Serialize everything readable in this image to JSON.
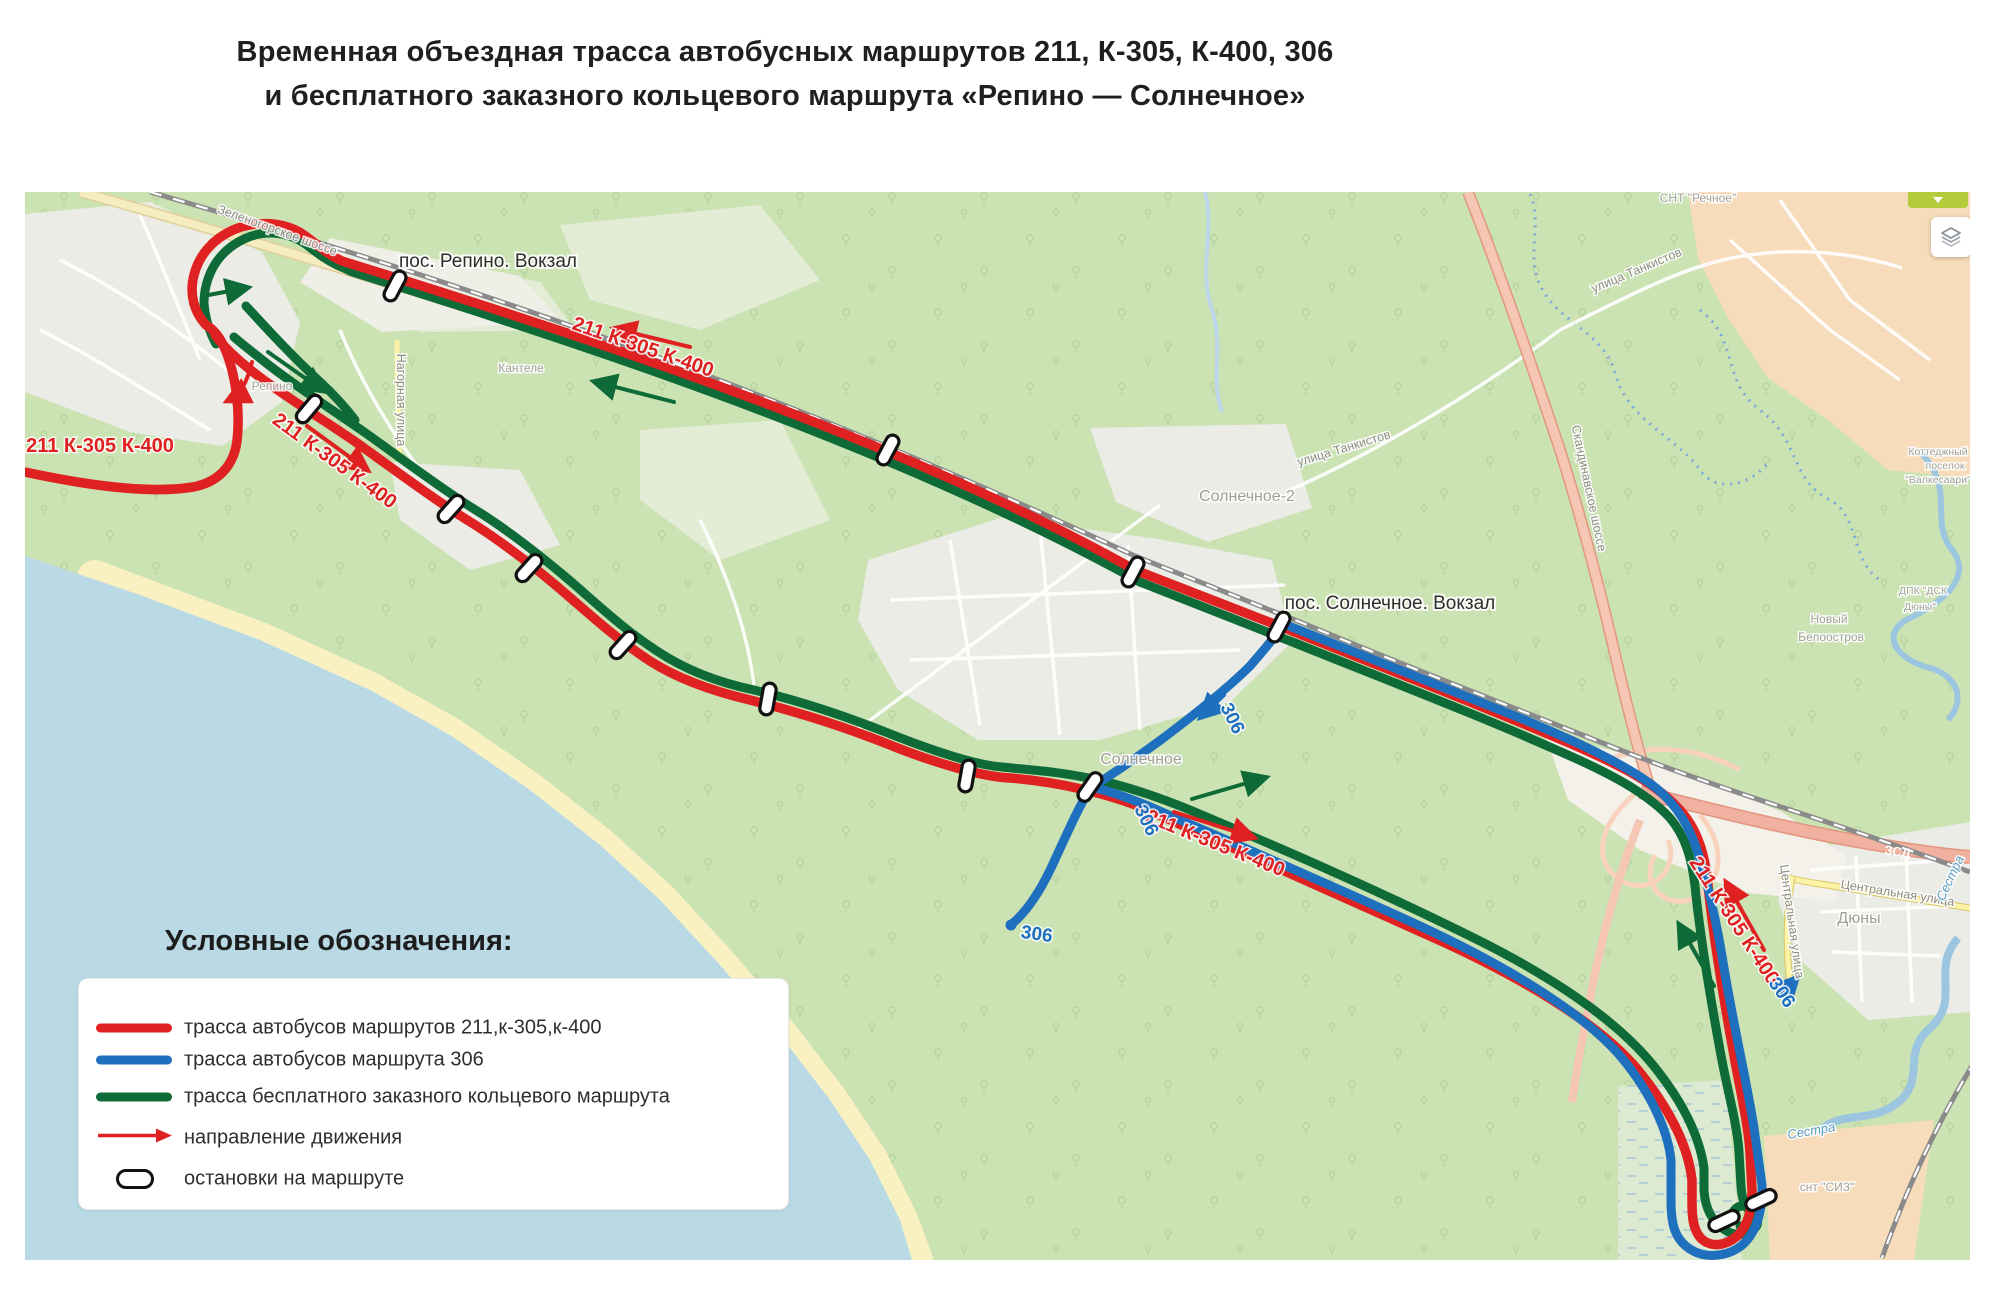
{
  "title": {
    "line1": "Временная объездная трасса автобусных маршрутов 211, К-305, К-400, 306",
    "line2": "и бесплатного заказного кольцевого маршрута «Репино — Солнечное»"
  },
  "legend": {
    "heading": "Условные обозначения:",
    "items": [
      {
        "swatch": "red-line",
        "label": "трасса автобусов маршрутов 211,к-305,к-400"
      },
      {
        "swatch": "blue-line",
        "label": "трасса автобусов маршрута 306"
      },
      {
        "swatch": "green-line",
        "label": "трасса бесплатного заказного кольцевого маршрута"
      },
      {
        "swatch": "red-arrow",
        "label": "направление движения"
      },
      {
        "swatch": "stop-pill",
        "label": "остановки на маршруте"
      }
    ]
  },
  "map": {
    "colors": {
      "route_red": "#e02121",
      "route_blue": "#1e6fbe",
      "route_green": "#0e6b38",
      "water": "#b9dae5",
      "beach": "#faf1c3",
      "forest": "#cbe2b3"
    },
    "controls": {
      "collapse_icon": "chevron-down-icon",
      "layers_icon": "layers-icon"
    },
    "labels": [
      {
        "id": "label-station-repino",
        "text": "пос. Репино. Вокзал",
        "x": 488,
        "y": 267,
        "rot": 0,
        "cls": "station"
      },
      {
        "id": "label-station-solnechnoe",
        "text": "пос. Солнечное. Вокзал",
        "x": 1390,
        "y": 609,
        "rot": 0,
        "cls": "station"
      },
      {
        "id": "label-route-red-west",
        "text": "211 К-305 К-400",
        "x": 100,
        "y": 452,
        "rot": 0,
        "cls": "route-red"
      },
      {
        "id": "label-route-red-repino",
        "text": "211 К-305 К-400",
        "x": 331,
        "y": 466,
        "rot": 36,
        "cls": "route-red"
      },
      {
        "id": "label-route-red-top",
        "text": "211 К-305 К-400",
        "x": 641,
        "y": 353,
        "rot": 19,
        "cls": "route-red"
      },
      {
        "id": "label-route-red-mid",
        "text": "211 К-305 К-400",
        "x": 1213,
        "y": 849,
        "rot": 22,
        "cls": "route-red"
      },
      {
        "id": "label-route-red-duny",
        "text": "211 К-305 К-400",
        "x": 1729,
        "y": 924,
        "rot": 57,
        "cls": "route-red"
      },
      {
        "id": "label-route-306-a",
        "text": "306",
        "x": 1227,
        "y": 721,
        "rot": 64,
        "cls": "route-blue"
      },
      {
        "id": "label-route-306-b",
        "text": "306",
        "x": 1141,
        "y": 823,
        "rot": 64,
        "cls": "route-blue"
      },
      {
        "id": "label-route-306-c",
        "text": "306",
        "x": 1777,
        "y": 996,
        "rot": 55,
        "cls": "route-blue"
      },
      {
        "id": "label-route-306-terminus",
        "text": "306",
        "x": 1036,
        "y": 940,
        "rot": 8,
        "cls": "route-blue"
      },
      {
        "id": "label-street-zelenogorskoe",
        "text": "Зеленогорское шоссе",
        "x": 276,
        "y": 234,
        "rot": 20,
        "cls": "street"
      },
      {
        "id": "label-street-nagornaya",
        "text": "Нагорная улица",
        "x": 397,
        "y": 400,
        "rot": 90,
        "cls": "street"
      },
      {
        "id": "label-street-tankistov-1",
        "text": "улица Танкистов",
        "x": 1345,
        "y": 452,
        "rot": -17,
        "cls": "street"
      },
      {
        "id": "label-street-tankistov-2",
        "text": "улица Танкистов",
        "x": 1638,
        "y": 274,
        "rot": -23,
        "cls": "street"
      },
      {
        "id": "label-street-skandinavskoe",
        "text": "Скандинавское шоссе",
        "x": 1585,
        "y": 489,
        "rot": 78,
        "cls": "street"
      },
      {
        "id": "label-street-centralnaya-1",
        "text": "Центральная улица",
        "x": 1897,
        "y": 897,
        "rot": 9,
        "cls": "street"
      },
      {
        "id": "label-street-centralnaya-2",
        "text": "Центральная улица",
        "x": 1788,
        "y": 922,
        "rot": 82,
        "cls": "street"
      },
      {
        "id": "label-place-kantele",
        "text": "Кантеле",
        "x": 521,
        "y": 372,
        "rot": 0,
        "cls": "place-small"
      },
      {
        "id": "label-place-repino",
        "text": "Репино",
        "x": 272,
        "y": 390,
        "rot": 0,
        "cls": "place-small"
      },
      {
        "id": "label-place-solnechnoe2",
        "text": "Солнечное-2",
        "x": 1247,
        "y": 501,
        "rot": 0,
        "cls": "place"
      },
      {
        "id": "label-place-solnechnoe",
        "text": "Солнечное",
        "x": 1141,
        "y": 764,
        "rot": 0,
        "cls": "place"
      },
      {
        "id": "label-place-duny",
        "text": "Дюны",
        "x": 1859,
        "y": 923,
        "rot": 0,
        "cls": "place"
      },
      {
        "id": "label-place-snt-rechnoe",
        "text": "СНТ \"Речное\"",
        "x": 1698,
        "y": 202,
        "rot": 0,
        "cls": "place-small"
      },
      {
        "id": "label-place-snt-siz",
        "text": "снт \"СИЗ\"",
        "x": 1827,
        "y": 1191,
        "rot": 0,
        "cls": "place-small"
      },
      {
        "id": "label-place-novy",
        "text": "Новый",
        "x": 1829,
        "y": 623,
        "rot": 0,
        "cls": "place-small"
      },
      {
        "id": "label-place-beloostrov",
        "text": "Белоостров",
        "x": 1831,
        "y": 641,
        "rot": 0,
        "cls": "place-small"
      },
      {
        "id": "label-place-kottedzhny",
        "text": "Коттеджный",
        "x": 1938,
        "y": 455,
        "rot": 0,
        "cls": "place-tiny"
      },
      {
        "id": "label-place-poselok",
        "text": "поселок",
        "x": 1945,
        "y": 469,
        "rot": 0,
        "cls": "place-tiny"
      },
      {
        "id": "label-place-valkesaari",
        "text": "\"Валкесаари\"",
        "x": 1938,
        "y": 483,
        "rot": 0,
        "cls": "place-tiny"
      },
      {
        "id": "label-place-dpk-1",
        "text": "ДПК \"ДСК",
        "x": 1923,
        "y": 594,
        "rot": 0,
        "cls": "place-tiny"
      },
      {
        "id": "label-place-dpk-2",
        "text": "Дюны\"",
        "x": 1920,
        "y": 610,
        "rot": 0,
        "cls": "place-tiny"
      },
      {
        "id": "label-river-sestra-1",
        "text": "Сестра",
        "x": 1812,
        "y": 1135,
        "rot": -10,
        "cls": "river"
      },
      {
        "id": "label-river-sestra-2",
        "text": "Сестра",
        "x": 1954,
        "y": 880,
        "rot": -65,
        "cls": "river"
      },
      {
        "id": "label-road-zsd",
        "text": "ЗСД",
        "x": 1897,
        "y": 856,
        "rot": 8,
        "cls": "road-shield"
      }
    ],
    "stops": [
      {
        "x": 395,
        "y": 286,
        "rot": -62
      },
      {
        "x": 888,
        "y": 450,
        "rot": -62
      },
      {
        "x": 1133,
        "y": 572,
        "rot": -62
      },
      {
        "x": 1279,
        "y": 627,
        "rot": -62
      },
      {
        "x": 309,
        "y": 409,
        "rot": -50
      },
      {
        "x": 451,
        "y": 509,
        "rot": -48
      },
      {
        "x": 529,
        "y": 568,
        "rot": -48
      },
      {
        "x": 623,
        "y": 645,
        "rot": -48
      },
      {
        "x": 768,
        "y": 699,
        "rot": -80
      },
      {
        "x": 967,
        "y": 776,
        "rot": -80
      },
      {
        "x": 1090,
        "y": 787,
        "rot": -55
      },
      {
        "x": 1724,
        "y": 1221,
        "rot": -25
      },
      {
        "x": 1761,
        "y": 1200,
        "rot": -25
      }
    ]
  }
}
